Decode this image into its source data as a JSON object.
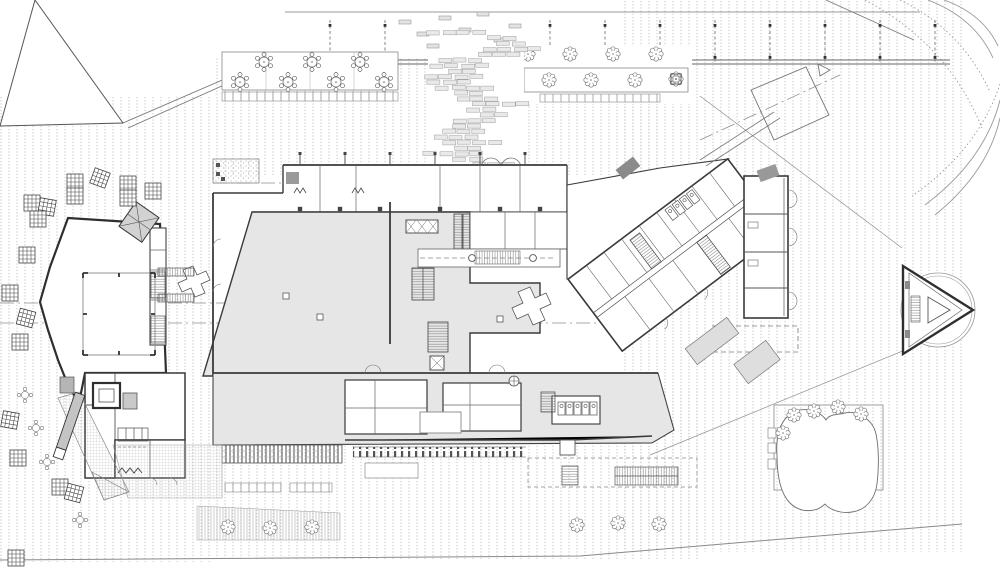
{
  "drawing": {
    "kind": "architectural-site-floor-plan",
    "paper_color": "#ffffff"
  },
  "palette": {
    "wall_dark": "#3a3a3a",
    "line_mid": "#6e6e6e",
    "line_light": "#9a9a9a",
    "hall_fill": "#e6e6e6",
    "mat_gray": "#a3a3a3",
    "dark_gray": "#8b8b8b",
    "platform_gray": "#d2d2d2",
    "hatch_dot": "#b6b6b6",
    "brick_fill": "#e9e9e9",
    "brick_line": "#9d9d9d"
  },
  "cascade": {
    "x_center": 474,
    "top": 30,
    "bottom": 164,
    "row_h": 5.5,
    "brick_w": 13,
    "brick_h": 4.2,
    "gap": 2,
    "seed": 7,
    "spread": 16
  },
  "canopy": {
    "posts_y": 16,
    "posts_x": [
      330,
      385,
      440,
      495,
      550,
      605,
      660,
      715,
      770,
      825,
      880,
      935
    ]
  },
  "facade_posts": {
    "y": 152,
    "x": [
      300,
      345,
      390,
      435,
      480,
      525
    ]
  },
  "stamps": {
    "square_tables": [
      [
        75,
        182,
        0
      ],
      [
        75,
        196,
        0
      ],
      [
        100,
        178,
        20
      ],
      [
        128,
        184,
        0
      ],
      [
        128,
        198,
        0
      ],
      [
        153,
        191,
        0
      ],
      [
        32,
        203,
        0
      ],
      [
        47,
        207,
        10
      ],
      [
        38,
        219,
        0
      ],
      [
        27,
        255,
        0
      ],
      [
        10,
        293,
        0
      ],
      [
        26,
        318,
        15
      ],
      [
        20,
        342,
        0
      ],
      [
        10,
        420,
        10
      ],
      [
        18,
        458,
        0
      ],
      [
        60,
        487,
        0
      ],
      [
        74,
        493,
        15
      ],
      [
        16,
        558,
        0
      ]
    ],
    "round_tables": [
      [
        240,
        82
      ],
      [
        264,
        62
      ],
      [
        288,
        82
      ],
      [
        312,
        62
      ],
      [
        336,
        82
      ],
      [
        360,
        62
      ],
      [
        384,
        82
      ]
    ],
    "round_small_tables": [
      [
        25,
        395
      ],
      [
        36,
        428
      ],
      [
        47,
        462
      ],
      [
        80,
        520
      ]
    ],
    "trees_upper_row": [
      [
        528,
        54
      ],
      [
        570,
        54
      ],
      [
        613,
        54
      ],
      [
        656,
        54
      ]
    ],
    "planter_trees": [
      [
        549,
        80
      ],
      [
        591,
        80
      ],
      [
        635,
        80
      ]
    ],
    "pot_trees": [
      [
        482,
        59
      ],
      [
        507,
        80
      ],
      [
        676,
        79
      ]
    ],
    "bottom_trees": [
      [
        228,
        527
      ],
      [
        270,
        528
      ],
      [
        312,
        527
      ],
      [
        577,
        525
      ],
      [
        618,
        523
      ],
      [
        659,
        524
      ]
    ],
    "pond_trees": [
      [
        794,
        415
      ],
      [
        814,
        411
      ],
      [
        838,
        407
      ],
      [
        861,
        414
      ],
      [
        783,
        433
      ]
    ],
    "scatter_benches": [
      [
        405,
        22
      ],
      [
        423,
        34
      ],
      [
        445,
        18
      ],
      [
        465,
        30
      ],
      [
        483,
        14
      ],
      [
        500,
        40
      ],
      [
        515,
        26
      ],
      [
        433,
        46
      ]
    ],
    "wc_cells_south": [
      [
        558,
        402
      ],
      [
        566,
        402
      ],
      [
        574,
        402
      ],
      [
        582,
        402
      ],
      [
        590,
        402
      ]
    ],
    "wc_cells_wing": [
      [
        694,
        213
      ],
      [
        703,
        213
      ],
      [
        712,
        213
      ],
      [
        721,
        213
      ]
    ],
    "hall_columns_sq": [
      [
        320,
        317
      ],
      [
        425,
        378
      ],
      [
        500,
        319
      ],
      [
        286,
        296
      ]
    ],
    "hall_columns_circ": [
      [
        472,
        258
      ],
      [
        533,
        258
      ],
      [
        79,
        281
      ],
      [
        79,
        347
      ]
    ],
    "wall_columns_dark": [
      [
        300,
        209
      ],
      [
        340,
        209
      ],
      [
        380,
        209
      ],
      [
        440,
        209
      ],
      [
        500,
        209
      ],
      [
        540,
        209
      ]
    ]
  }
}
